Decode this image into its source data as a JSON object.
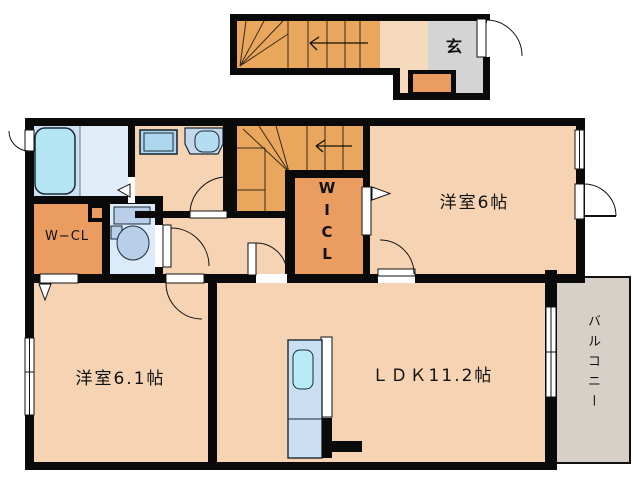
{
  "plan": {
    "entrance": {
      "genkan_label": "玄"
    },
    "rooms": {
      "western6": {
        "label": "洋室6帖"
      },
      "western61": {
        "label": "洋室6.1帖"
      },
      "ldk": {
        "label": "ＬＤＫ11.2帖"
      },
      "balcony": {
        "label": "バルコニー"
      },
      "wcl": {
        "label": "W−CL"
      },
      "wicl": {
        "chars": [
          "W",
          "I",
          "C",
          "L"
        ]
      }
    }
  },
  "colors": {
    "wall": "#0a0a0a",
    "floor_peach": "#f5d3b3",
    "landing_peach": "#f6dabd",
    "stairs_orange": "#e9a75d",
    "closet_orange": "#eb9c60",
    "genkan_gray": "#d4d4d4",
    "balcony_gray": "#d6d0c8",
    "bathroom_blue": "#cfe1f1",
    "bathroom_panel_blue": "#e0edf9",
    "toilet_room_blue": "#dcebf9",
    "bathtub_cyan": "#b3e6f2",
    "fixture_blue": "#b9cfe9",
    "washer_blue": "#aed6ee",
    "vanity_blue": "#c4d7eb",
    "vanity_bowl_cyan": "#b4ddf2",
    "kitchen_blue": "#cbdff3",
    "kitchen_sink_cyan": "#b6ebf7",
    "white": "#ffffff"
  }
}
